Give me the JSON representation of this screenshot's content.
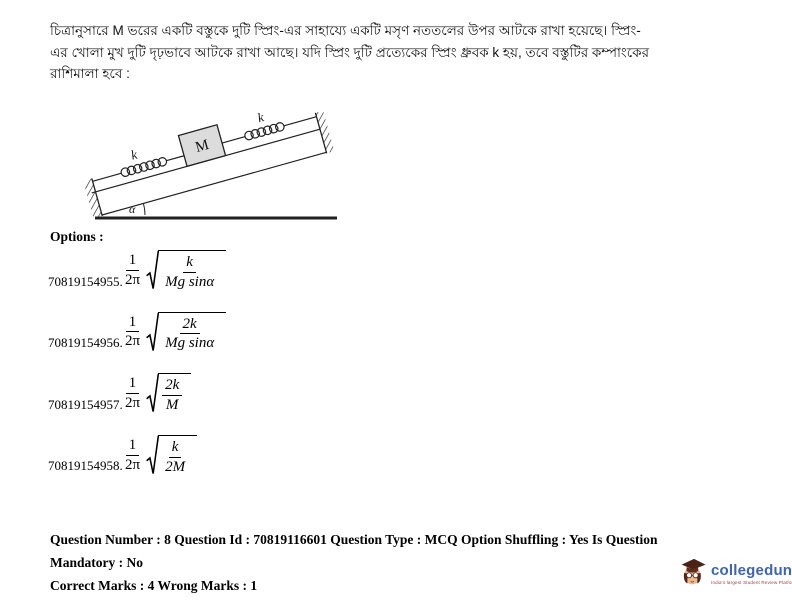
{
  "question": {
    "lines": [
      "চিত্রানুসারে M ভরের একটি বস্তুকে দুটি স্প্রিং-এর সাহায্যে একটি মসৃণ নততলের উপর আটকে রাখা হয়েছে।  স্প্রিং-",
      "এর খোলা মুখ দুটি দৃঢ়ভাবে আটকে রাখা আছে।  যদি স্প্রিং দুটি প্রত্যেকের স্প্রিং ধ্রুবক k হয়, তবে বস্তুটির কম্পাংকের",
      "রাশিমালা হবে :"
    ]
  },
  "diagram": {
    "block_label": "M",
    "left_spring_label": "k",
    "right_spring_label": "k",
    "angle_label": "α"
  },
  "options": {
    "heading": "Options :",
    "prefix_numerator": "1",
    "prefix_denominator": "2π",
    "items": [
      {
        "id": "70819154955.",
        "numerator": "k",
        "denominator": "Mg sinα"
      },
      {
        "id": "70819154956.",
        "numerator": "2k",
        "denominator": "Mg sinα"
      },
      {
        "id": "70819154957.",
        "numerator": "2k",
        "denominator": "M"
      },
      {
        "id": "70819154958.",
        "numerator": "k",
        "denominator": "2M"
      }
    ]
  },
  "footer": {
    "line1": "Question Number : 8 Question Id : 70819116601 Question Type : MCQ Option Shuffling : Yes Is Question Mandatory : No",
    "line2": "Correct Marks : 4 Wrong Marks : 1"
  },
  "branding": {
    "name": "collegedunia",
    "tagline": "India's largest Student Review Platform",
    "brand_color": "#3f63ac"
  }
}
